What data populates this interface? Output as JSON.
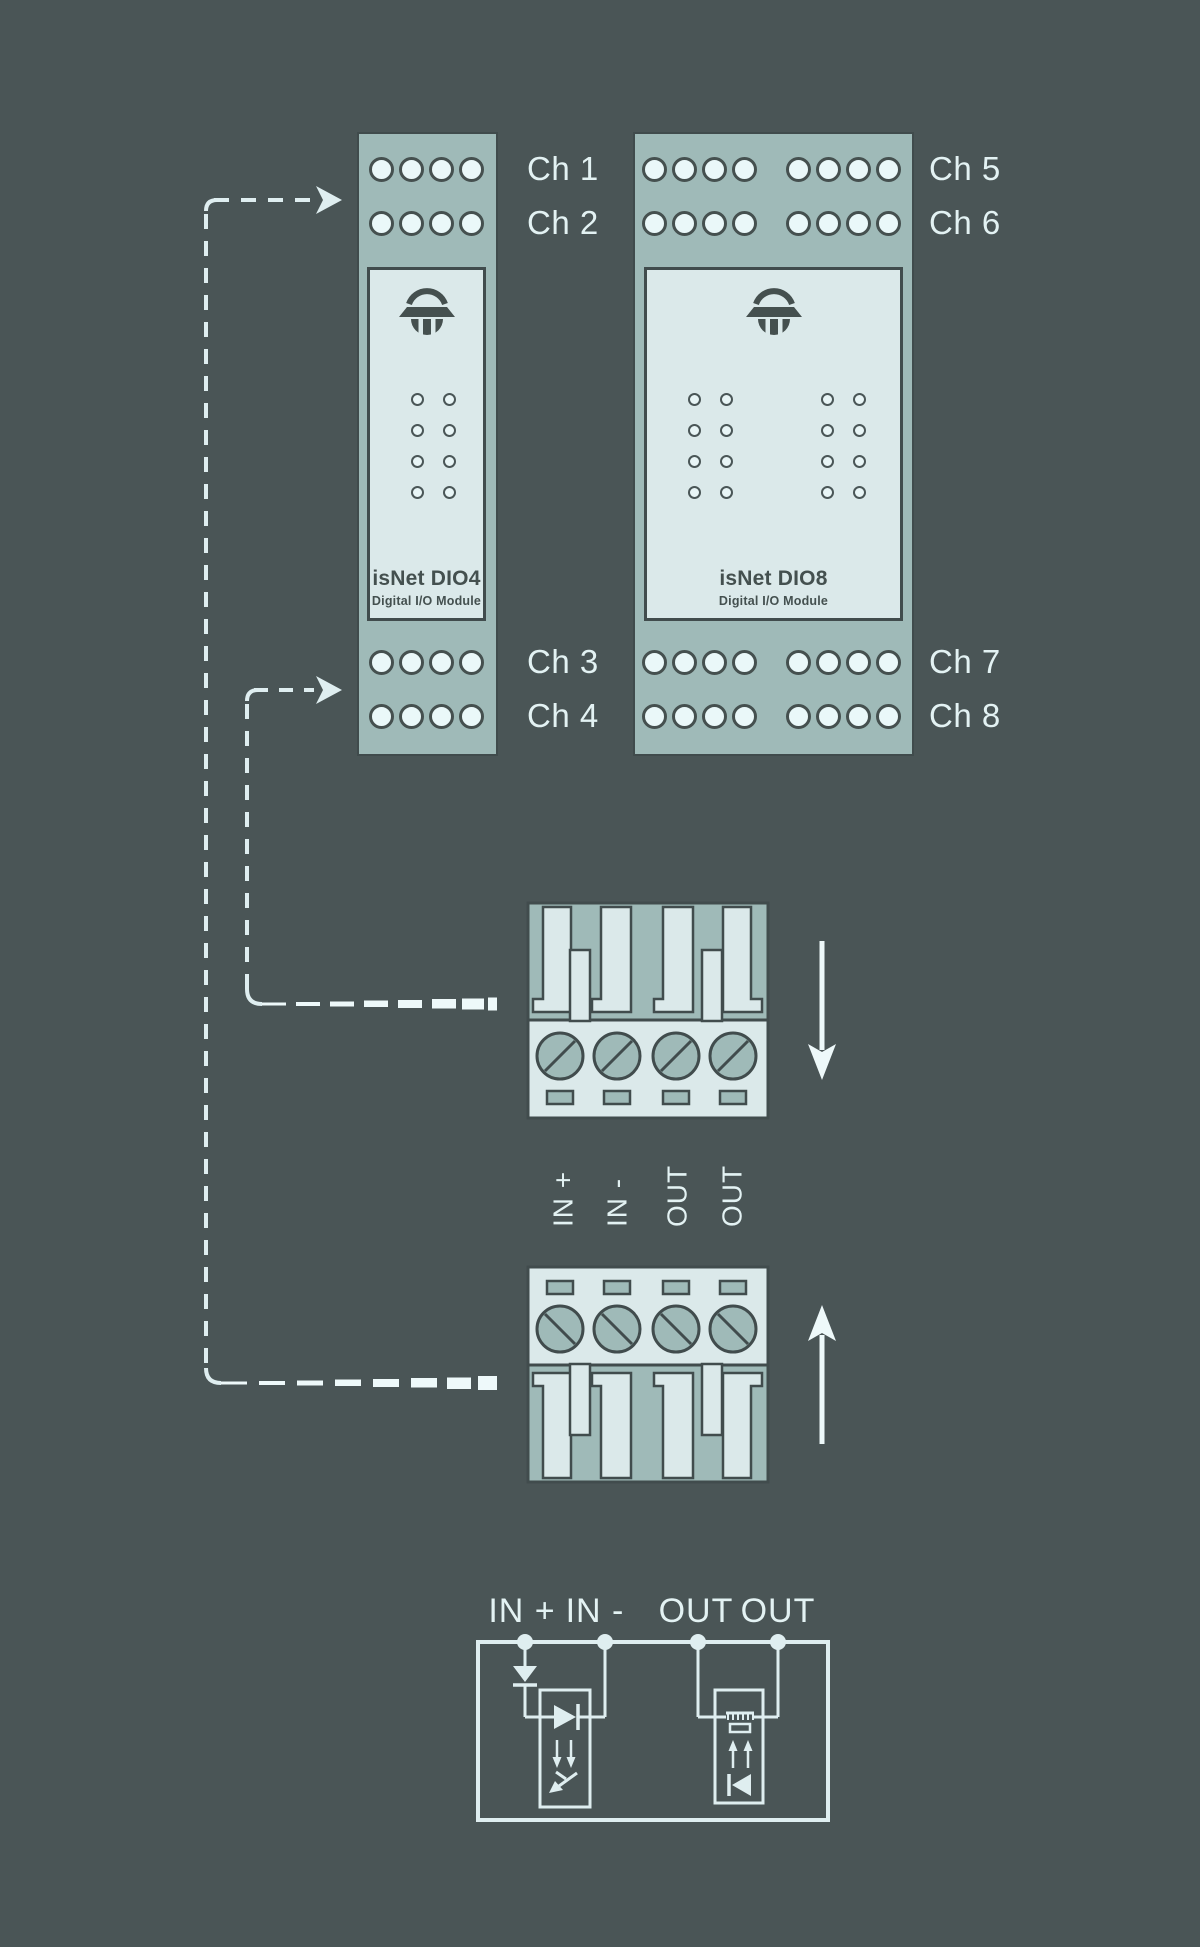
{
  "colors": {
    "background": "#4a5556",
    "panel_sage": "#9fbab8",
    "panel_face": "#dbe9ea",
    "outline_ink": "#414c4d",
    "line_light": "#dfeef0",
    "text_light": "#e3f2f3",
    "text_dark": "#44504f"
  },
  "modules": {
    "dio4": {
      "name": "isNet DIO4",
      "subtitle": "Digital I/O Module"
    },
    "dio8": {
      "name": "isNet DIO8",
      "subtitle": "Digital I/O Module"
    }
  },
  "channels": {
    "ch1": "Ch 1",
    "ch2": "Ch 2",
    "ch3": "Ch 3",
    "ch4": "Ch 4",
    "ch5": "Ch 5",
    "ch6": "Ch 6",
    "ch7": "Ch 7",
    "ch8": "Ch 8"
  },
  "connector": {
    "pin_labels": [
      "IN +",
      "IN -",
      "OUT",
      "OUT"
    ]
  },
  "circuit": {
    "labels": [
      "IN +",
      "IN -",
      "OUT",
      "OUT"
    ]
  }
}
